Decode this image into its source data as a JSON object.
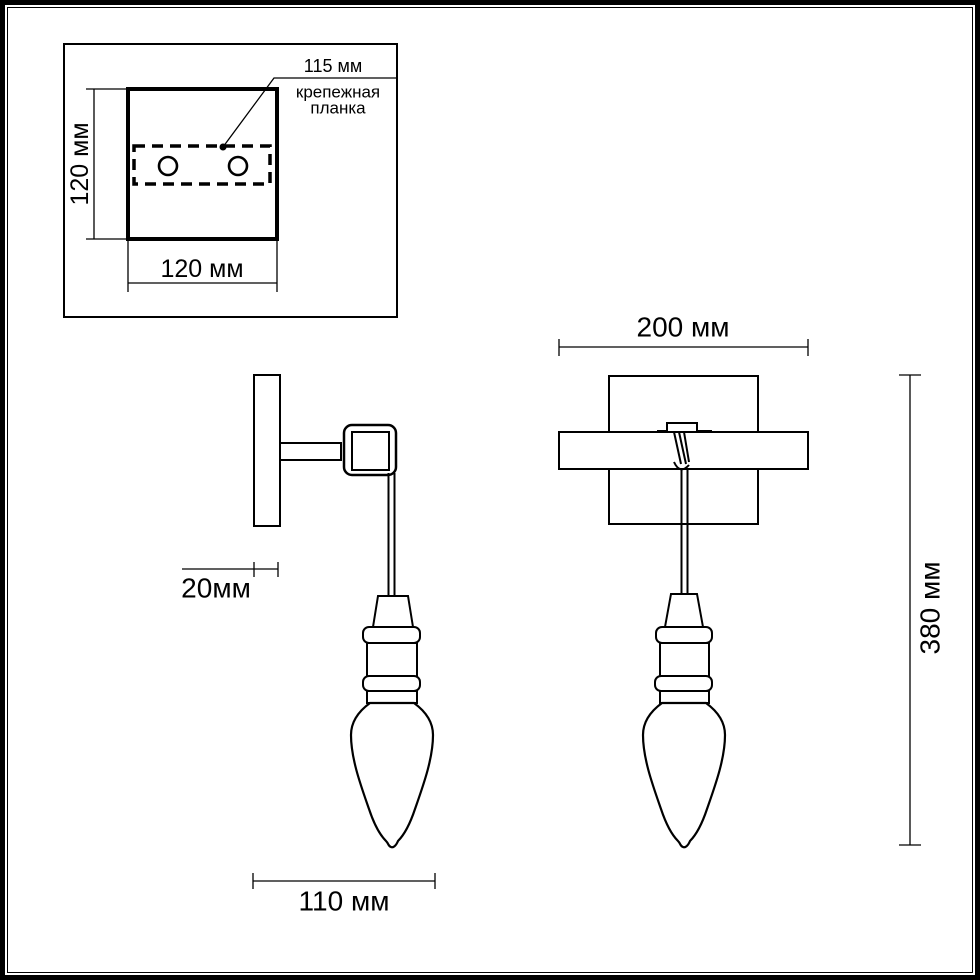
{
  "colors": {
    "line": "#000000",
    "background": "#ffffff"
  },
  "inset_detail": {
    "height_label": "120 мм",
    "width_label": "120 мм",
    "holes_spacing_label": "115 мм",
    "bracket_caption_line1": "крепежная",
    "bracket_caption_line2": "планка"
  },
  "side_view": {
    "plate_depth_label": "20мм",
    "projection_label": "110 мм"
  },
  "front_view": {
    "width_label": "200 мм",
    "height_label": "380 мм"
  }
}
